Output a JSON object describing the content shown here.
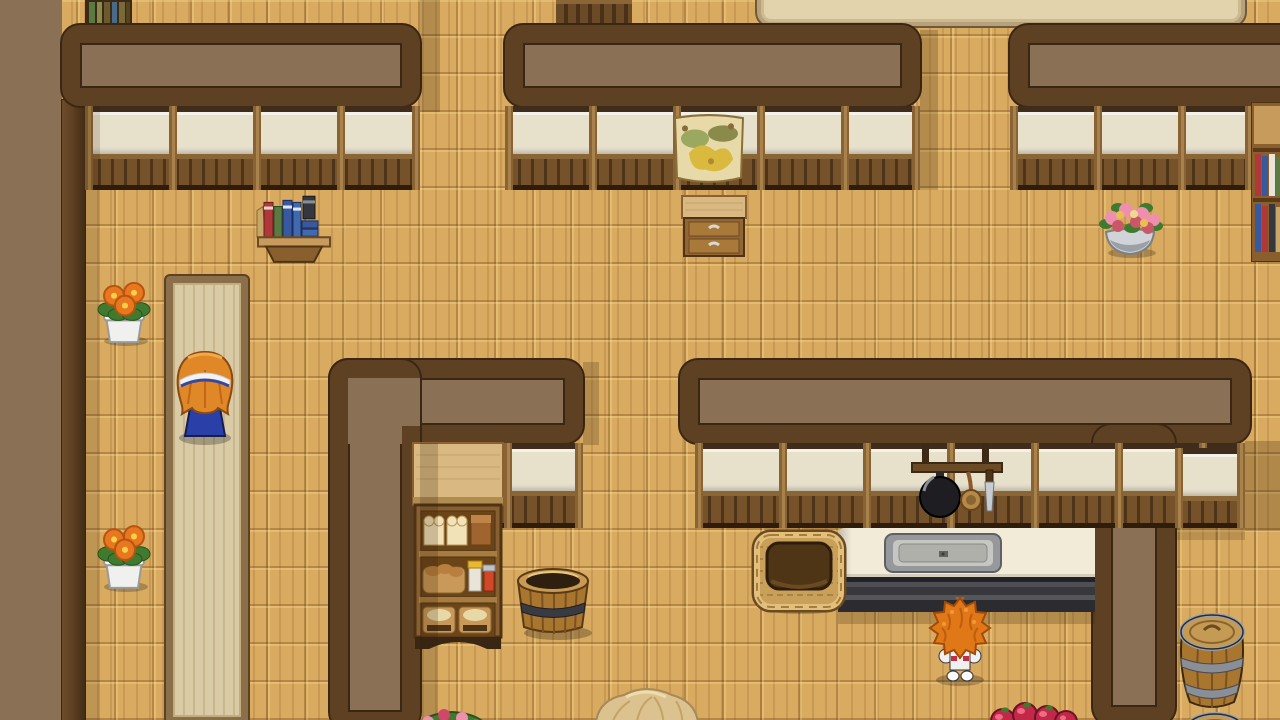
{
  "meta": {
    "domain": "Game",
    "scene_label": "rpg-style-house-interior-bakery-kitchen",
    "viewport": {
      "width": 1280,
      "height": 720
    },
    "visible_text": []
  },
  "palette": {
    "floor_base": "#d8ab61",
    "wall_fill": "#8a7054",
    "wall_band": "#5e4023",
    "wall_outline": "#3a2612",
    "pane": "#e7e1cc",
    "lintel": "#3f2c1a",
    "wainscot": "#75522a",
    "post": "#8a6334",
    "post_hi": "#a8824c",
    "carpet_fill": "#d9cba6",
    "carpet_border": "#8b6f4a",
    "counter_top": "#f2ebd7",
    "counter_base": "#35353a",
    "shadow_rgb": "50,30,8",
    "hair_orange": "#e08828",
    "skirt_blue": "#2a3fa8",
    "book_red": "#b03838",
    "book_green": "#5a7a42",
    "book_blue": "#3858a0",
    "apple_red": "#c22848",
    "flower_orange": "#e87820",
    "flower_pink": "#ef8fae",
    "wood_mid": "#a9762f",
    "wood_dark": "#6b4a26"
  },
  "scene": {
    "notes": {
      "girl": "child sprite seen from behind, orange bob hair, white headband, blue skirt, standing on carpet runner",
      "creature": "small sprite with huge spiky orange hair facing the kitchen counter",
      "kitchen-counter": "white countertop with inset metal sink, dark striped base",
      "bread-shelf": "display shelf: white+brown loaves, bread basket with jars, two pastry baskets",
      "hanging-rack": "wall bar with black frying pan, wooden ladle, knife",
      "poster-map": "parchment map pinned over window",
      "barrels": "wooden barrels with metal hoops at lower right edge",
      "upstairs-strip": "top edge shows floor of another room with shelf tops and a large beige table"
    },
    "elements": {
      "floor-parquet": {
        "x": 0,
        "y": 0,
        "w": 1280,
        "h": 720
      },
      "upstairs-bookshelf-top": {
        "x": 85,
        "y": 0,
        "w": 47,
        "h": 26
      },
      "upstairs-cabinet-top": {
        "x": 556,
        "y": 0,
        "w": 76,
        "h": 26
      },
      "upstairs-table": {
        "x": 757,
        "y": -34,
        "w": 488,
        "h": 60
      },
      "left-wall-fill": {
        "x": 0,
        "y": 0,
        "w": 62,
        "h": 720
      },
      "left-wall-band": {
        "x": 62,
        "y": 100,
        "w": 23,
        "h": 620
      },
      "wall-top-left": {
        "x": 62,
        "y": 25,
        "w": 358,
        "h": 81
      },
      "wall-top-center": {
        "x": 505,
        "y": 25,
        "w": 415,
        "h": 81
      },
      "wall-top-right": {
        "x": 1010,
        "y": 25,
        "w": 292,
        "h": 81
      },
      "window-face-left": {
        "x": 85,
        "y": 106,
        "w": 335,
        "h": 84
      },
      "window-face-center": {
        "x": 505,
        "y": 106,
        "w": 415,
        "h": 84
      },
      "window-face-right": {
        "x": 1010,
        "y": 106,
        "w": 243,
        "h": 84
      },
      "poster-map": {
        "x": 671,
        "y": 112,
        "w": 76,
        "h": 74
      },
      "right-bookshelf": {
        "x": 1251,
        "y": 102,
        "w": 34,
        "h": 160
      },
      "shadow-doorway-top": {
        "x": 420,
        "y": 0,
        "w": 20,
        "h": 112,
        "a": 0.22
      },
      "shadow-corridor-top": {
        "x": 920,
        "y": 30,
        "w": 18,
        "h": 160,
        "a": 0.22
      },
      "shadow-left-wall": {
        "x": 85,
        "y": 106,
        "w": 15,
        "h": 614,
        "a": 0.15
      },
      "wall-shelf-books": {
        "x": 256,
        "y": 186,
        "w": 76,
        "h": 80
      },
      "drawer-cabinet": {
        "x": 681,
        "y": 194,
        "w": 66,
        "h": 64
      },
      "flower-pot-upper": {
        "x": 92,
        "y": 279,
        "w": 64,
        "h": 67
      },
      "flower-pot-lower": {
        "x": 92,
        "y": 522,
        "w": 64,
        "h": 70
      },
      "pink-flower-bowl": {
        "x": 1096,
        "y": 196,
        "w": 68,
        "h": 62
      },
      "carpet-runner": {
        "x": 166,
        "y": 276,
        "w": 82,
        "h": 448
      },
      "wall-left-room-v": {
        "x": 330,
        "y": 360,
        "w": 90,
        "h": 370
      },
      "wall-left-room-h": {
        "x": 330,
        "y": 360,
        "w": 253,
        "h": 83
      },
      "wall-patch-1": {
        "x": 348,
        "y": 378,
        "w": 54,
        "h": 66
      },
      "wall-patch-2": {
        "x": 402,
        "y": 378,
        "w": 18,
        "h": 48
      },
      "window-face-bakery": {
        "x": 420,
        "y": 443,
        "w": 163,
        "h": 85
      },
      "shadow-wall-end": {
        "x": 583,
        "y": 362,
        "w": 16,
        "h": 83,
        "a": 0.22
      },
      "wall-kitchen-north": {
        "x": 680,
        "y": 360,
        "w": 570,
        "h": 83
      },
      "wall-kitchen-east": {
        "x": 1093,
        "y": 425,
        "w": 82,
        "h": 300
      },
      "window-face-kitchen": {
        "x": 695,
        "y": 443,
        "w": 550,
        "h": 85
      },
      "window-face-corridor": {
        "x": 1175,
        "y": 448,
        "w": 70,
        "h": 80
      },
      "shadow-kitchen-corner": {
        "x": 1245,
        "y": 441,
        "w": 35,
        "h": 90,
        "a": 0.25
      },
      "shadow-corridor-window": {
        "x": 1175,
        "y": 528,
        "w": 70,
        "h": 12,
        "a": 0.18
      },
      "bread-shelf": {
        "x": 411,
        "y": 441,
        "w": 94,
        "h": 208
      },
      "shadow-bakery-wall": {
        "x": 420,
        "y": 443,
        "w": 18,
        "h": 277,
        "a": 0.2
      },
      "hanging-rack": {
        "x": 910,
        "y": 443,
        "w": 94,
        "h": 82
      },
      "kitchen-counter": {
        "x": 838,
        "y": 528,
        "w": 257,
        "h": 84
      },
      "shadow-counter": {
        "x": 838,
        "y": 612,
        "w": 257,
        "h": 12,
        "a": 0.22
      },
      "wicker-basket": {
        "x": 751,
        "y": 525,
        "w": 96,
        "h": 89
      },
      "bucket": {
        "x": 504,
        "y": 543,
        "w": 98,
        "h": 98
      },
      "girl": {
        "x": 168,
        "y": 348,
        "w": 74,
        "h": 98
      },
      "creature": {
        "x": 922,
        "y": 594,
        "w": 76,
        "h": 92
      },
      "barrel-upper": {
        "x": 1176,
        "y": 610,
        "w": 72,
        "h": 108
      },
      "barrel-lower": {
        "x": 1182,
        "y": 698,
        "w": 66,
        "h": 40
      },
      "apples": {
        "x": 983,
        "y": 691,
        "w": 96,
        "h": 46
      },
      "flower-basket-bottom": {
        "x": 410,
        "y": 698,
        "w": 84,
        "h": 40
      },
      "hay-sack": {
        "x": 586,
        "y": 681,
        "w": 120,
        "h": 55
      }
    }
  }
}
